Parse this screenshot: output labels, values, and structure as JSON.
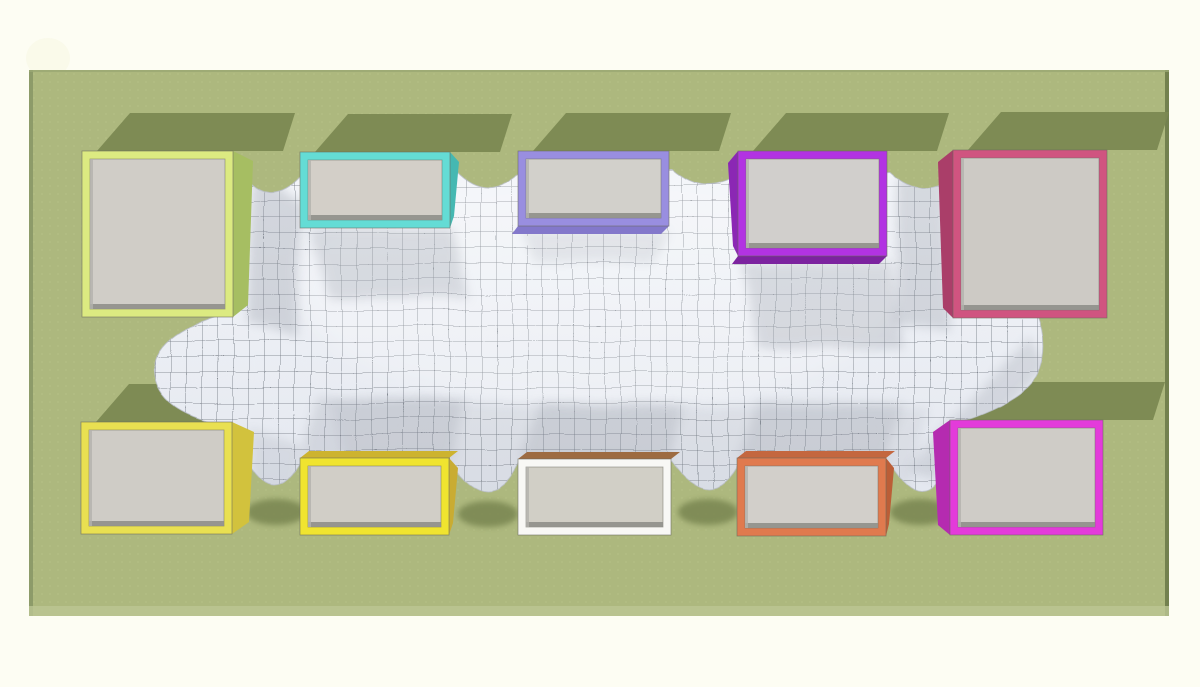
{
  "scene": {
    "title": "cloth mesh stretched between ten colored boxes on a green ground (3D physics render, top view)",
    "background_color": "#fdfdf3",
    "ground": {
      "color": "#adb87e",
      "edge_left": "#8d9b69",
      "edge_right": "#73814f",
      "edge_top": "#9aa873",
      "edge_bottom": "#bcc693",
      "dot_color": "#bcc78d",
      "x": 29,
      "y": 70,
      "w": 1140,
      "h": 546
    },
    "shadow_color": "#7b8852",
    "mesh": {
      "top_color": "#f4f6fa",
      "bottom_color": "#e2e6ee",
      "grid_color": "#434a55",
      "cell_size": 15.5,
      "soft_shadow_color": "#8d939e",
      "edge_color": "#b9bec8",
      "outline_path": "M 236,172 L 240,172 Q 268,212 300,178 L 455,170 Q 486,202 518,174 L 672,170 Q 706,200 740,174 L 890,172 Q 922,202 955,176 L 1046,180 L 1038,312 Q 1050,342 1041,368 Q 1032,400 955,424 L 1046,430 L 1046,468 L 945,466 Q 924,518 890,464 L 740,462 Q 712,517 672,462 L 520,462 Q 490,520 450,462 L 302,460 Q 274,514 245,458 L 180,452 L 230,426 Q 158,414 154,372 Q 151,332 238,310 Z"
    },
    "frame_thickness": 8,
    "boxes": [
      {
        "id": "top-1",
        "row": "top",
        "x": 82,
        "y": 151,
        "w": 151,
        "h": 166,
        "frame": "#dcea81",
        "face": "#d0cdc7",
        "side": "right",
        "side_w": 20,
        "side_color": "#a6be62"
      },
      {
        "id": "top-2",
        "row": "top",
        "x": 300,
        "y": 152,
        "w": 150,
        "h": 76,
        "frame": "#64dcd5",
        "face": "#d3cfc8",
        "side": "right",
        "side_w": 9,
        "side_color": "#45b8b2"
      },
      {
        "id": "top-3",
        "row": "top",
        "x": 518,
        "y": 151,
        "w": 151,
        "h": 75,
        "frame": "#998ee0",
        "face": "#d2d0cb",
        "side": "none",
        "bottom_strip": "#8378cb"
      },
      {
        "id": "top-4",
        "row": "top",
        "x": 738,
        "y": 151,
        "w": 149,
        "h": 105,
        "frame": "#b233e2",
        "face": "#d1cfcc",
        "side": "left",
        "side_w": 10,
        "side_color": "#8b27b4",
        "bottom_strip": "#7c239f"
      },
      {
        "id": "top-5",
        "row": "top",
        "x": 953,
        "y": 150,
        "w": 154,
        "h": 168,
        "frame": "#d05480",
        "face": "#cdcac5",
        "side": "left",
        "side_w": 15,
        "side_color": "#aa3e69"
      },
      {
        "id": "bottom-1",
        "row": "bottom",
        "x": 81,
        "y": 422,
        "w": 151,
        "h": 112,
        "frame": "#e9e051",
        "face": "#cfccc6",
        "side": "right",
        "side_w": 22,
        "side_color": "#d2c23d"
      },
      {
        "id": "bottom-2",
        "row": "bottom",
        "x": 300,
        "y": 458,
        "w": 149,
        "h": 77,
        "frame": "#f0e42f",
        "face": "#d1cec7",
        "side": "right",
        "side_w": 9,
        "side_color": "#c9ac32",
        "top_strip": "#cdb32f"
      },
      {
        "id": "bottom-3",
        "row": "bottom",
        "x": 518,
        "y": 459,
        "w": 153,
        "h": 76,
        "frame": "#f8f8f5",
        "face": "#d1cfc6",
        "side": "none",
        "top_strip": "#9d6b41"
      },
      {
        "id": "bottom-4",
        "row": "bottom",
        "x": 737,
        "y": 458,
        "w": 149,
        "h": 78,
        "frame": "#e07a4e",
        "face": "#d2cfca",
        "side": "right",
        "side_w": 8,
        "side_color": "#bb5e37",
        "top_strip": "#c4673f"
      },
      {
        "id": "bottom-5",
        "row": "bottom",
        "x": 950,
        "y": 420,
        "w": 153,
        "h": 115,
        "frame": "#e33bda",
        "face": "#cfccc7",
        "side": "left",
        "side_w": 17,
        "side_color": "#b52bb0"
      }
    ],
    "mesh_soft_shadows": [
      {
        "pts": [
          [
            252,
            170
          ],
          [
            302,
            205
          ],
          [
            296,
            338
          ],
          [
            248,
            322
          ]
        ],
        "o": 0.3
      },
      {
        "pts": [
          [
            310,
            228
          ],
          [
            452,
            228
          ],
          [
            468,
            298
          ],
          [
            330,
            298
          ]
        ],
        "o": 0.26
      },
      {
        "pts": [
          [
            520,
            230
          ],
          [
            668,
            230
          ],
          [
            652,
            264
          ],
          [
            535,
            262
          ]
        ],
        "o": 0.16
      },
      {
        "pts": [
          [
            740,
            262
          ],
          [
            889,
            262
          ],
          [
            904,
            348
          ],
          [
            760,
            348
          ]
        ],
        "o": 0.26
      },
      {
        "pts": [
          [
            898,
            178
          ],
          [
            944,
            178
          ],
          [
            950,
            332
          ],
          [
            894,
            322
          ]
        ],
        "o": 0.28
      },
      {
        "pts": [
          [
            330,
            400
          ],
          [
            930,
            408
          ],
          [
            900,
            518
          ],
          [
            360,
            512
          ]
        ],
        "o": 0.13
      },
      {
        "pts": [
          [
            318,
            396
          ],
          [
            465,
            400
          ],
          [
            452,
            459
          ],
          [
            302,
            457
          ]
        ],
        "o": 0.22
      },
      {
        "pts": [
          [
            540,
            404
          ],
          [
            685,
            407
          ],
          [
            668,
            460
          ],
          [
            520,
            458
          ]
        ],
        "o": 0.22
      },
      {
        "pts": [
          [
            758,
            400
          ],
          [
            905,
            403
          ],
          [
            884,
            459
          ],
          [
            739,
            457
          ]
        ],
        "o": 0.22
      },
      {
        "pts": [
          [
            908,
            470
          ],
          [
            1030,
            336
          ],
          [
            1048,
            366
          ],
          [
            935,
            480
          ]
        ],
        "o": 0.24
      },
      {
        "pts": [
          [
            250,
            430
          ],
          [
            302,
            446
          ],
          [
            292,
            512
          ],
          [
            252,
            502
          ]
        ],
        "o": 0.18
      }
    ],
    "drape_shadows": [
      [
        276,
        512
      ],
      [
        488,
        514
      ],
      [
        708,
        512
      ],
      [
        920,
        512
      ]
    ],
    "box_ground_shadow": {
      "dx_bottom_left": 15,
      "dx_top_left": 48,
      "dx_top_right": 62,
      "dx_bottom_right": 50,
      "height": 38
    }
  }
}
